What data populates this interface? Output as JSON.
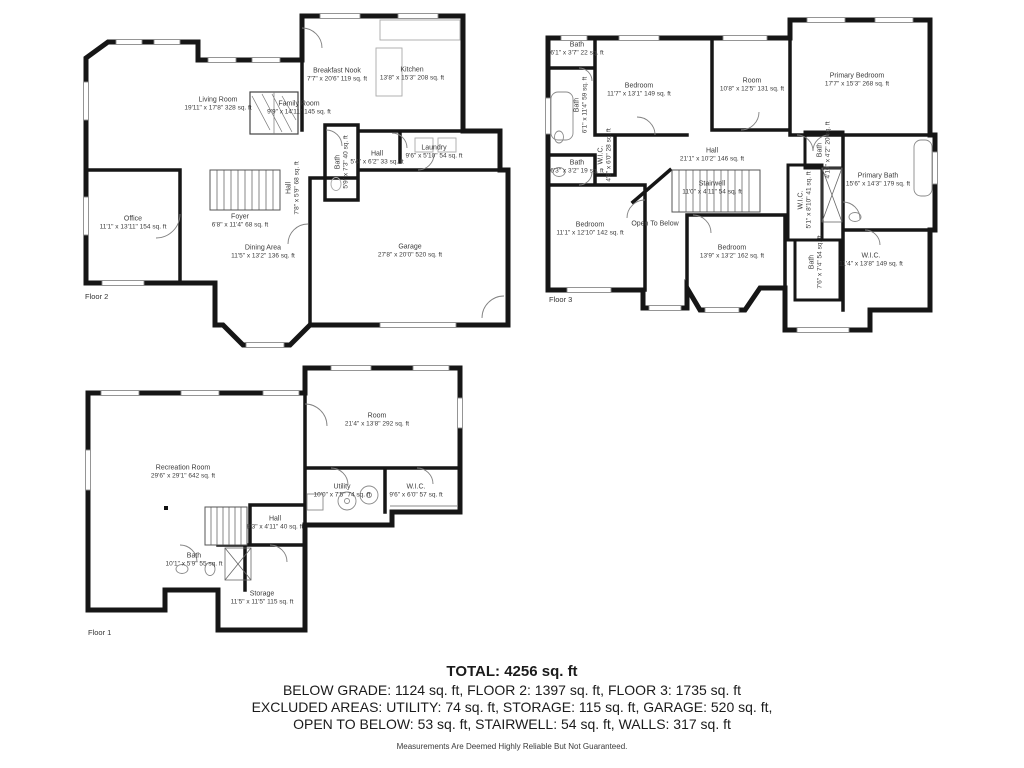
{
  "colors": {
    "wall": "#161616",
    "text": "#3c3c3c",
    "fixture": "#8a8a8a"
  },
  "summary": {
    "total": "TOTAL: 4256 sq. ft",
    "line2": "BELOW GRADE: 1124 sq. ft, FLOOR 2: 1397 sq. ft, FLOOR 3: 1735 sq. ft",
    "line3": "EXCLUDED AREAS: UTILITY: 74 sq. ft, STORAGE: 115 sq. ft, GARAGE: 520 sq. ft,",
    "line4": "OPEN TO BELOW: 53 sq. ft, STAIRWELL: 54 sq. ft, WALLS: 317 sq. ft",
    "disclaimer": "Measurements Are Deemed Highly Reliable But Not Guaranteed."
  },
  "floors": {
    "f2": {
      "label": "Floor 2",
      "rooms": {
        "living": {
          "name": "Living Room",
          "dims": "19'11\" x 17'8\" 328 sq. ft"
        },
        "family": {
          "name": "Family Room",
          "dims": "9'9\" x 14'11\" 145 sq. ft"
        },
        "breakfast": {
          "name": "Breakfast Nook",
          "dims": "7'7\" x 20'6\" 119 sq. ft"
        },
        "kitchen": {
          "name": "Kitchen",
          "dims": "13'8\" x 15'3\" 208 sq. ft"
        },
        "bath": {
          "name": "Bath",
          "dims": "5'9\" x 7'3\" 40 sq. ft"
        },
        "hall_small": {
          "name": "Hall",
          "dims": "5'4\" x 6'2\" 33 sq. ft"
        },
        "laundry": {
          "name": "Laundry",
          "dims": "9'6\" x 5'10\" 54 sq. ft"
        },
        "hall_stairs": {
          "name": "Hall",
          "dims": "7'8\" x 5'9\" 68 sq. ft"
        },
        "office": {
          "name": "Office",
          "dims": "11'1\" x 13'11\" 154 sq. ft"
        },
        "foyer": {
          "name": "Foyer",
          "dims": "6'8\" x 11'4\" 68 sq. ft"
        },
        "dining": {
          "name": "Dining Area",
          "dims": "11'5\" x 13'2\" 136 sq. ft"
        },
        "garage": {
          "name": "Garage",
          "dims": "27'8\" x 20'0\" 520 sq. ft"
        }
      }
    },
    "f3": {
      "label": "Floor 3",
      "rooms": {
        "bath22": {
          "name": "Bath",
          "dims": "6'1\" x 3'7\" 22 sq. ft"
        },
        "bath59": {
          "name": "Bath",
          "dims": "6'1\" x 11'4\" 59 sq. ft"
        },
        "bedroom1": {
          "name": "Bedroom",
          "dims": "11'7\" x 13'1\" 149 sq. ft"
        },
        "room": {
          "name": "Room",
          "dims": "10'8\" x 12'5\" 131 sq. ft"
        },
        "primary_bedroom": {
          "name": "Primary Bedroom",
          "dims": "17'7\" x 15'3\" 268 sq. ft"
        },
        "wic28": {
          "name": "W.I.C.",
          "dims": "4'8\" x 6'0\" 28 sq. ft"
        },
        "bath19": {
          "name": "Bath",
          "dims": "6'3\" x 3'2\" 19 sq. ft"
        },
        "hall": {
          "name": "Hall",
          "dims": "21'1\" x 10'2\" 146 sq. ft"
        },
        "stairwell": {
          "name": "Stairwell",
          "dims": "11'0\" x 4'11\" 54 sq. ft"
        },
        "bedroom_left": {
          "name": "Bedroom",
          "dims": "11'1\" x 12'10\" 142 sq. ft"
        },
        "open_below": {
          "name": "Open To Below",
          "dims": ""
        },
        "bedroom_center": {
          "name": "Bedroom",
          "dims": "13'9\" x 13'2\" 162 sq. ft"
        },
        "bath20": {
          "name": "Bath",
          "dims": "4'10\" x 4'2\" 20 sq. ft"
        },
        "wic41": {
          "name": "W.I.C.",
          "dims": "5'1\" x 8'10\" 41 sq. ft"
        },
        "primary_bath": {
          "name": "Primary Bath",
          "dims": "15'6\" x 14'3\" 179 sq. ft"
        },
        "bath54": {
          "name": "Bath",
          "dims": "7'6\" x 7'4\" 54 sq. ft"
        },
        "wic149": {
          "name": "W.I.C.",
          "dims": "11'4\" x 13'8\" 149 sq. ft"
        }
      }
    },
    "f1": {
      "label": "Floor 1",
      "rooms": {
        "recreation": {
          "name": "Recreation Room",
          "dims": "29'6\" x 29'1\" 642 sq. ft"
        },
        "room": {
          "name": "Room",
          "dims": "21'4\" x 13'8\" 292 sq. ft"
        },
        "utility": {
          "name": "Utility",
          "dims": "10'0\" x 7'5\" 74 sq. ft"
        },
        "wic": {
          "name": "W.I.C.",
          "dims": "9'6\" x 6'0\" 57 sq. ft"
        },
        "hall": {
          "name": "Hall",
          "dims": "8'3\" x 4'11\" 40 sq. ft"
        },
        "bath": {
          "name": "Bath",
          "dims": "10'1\" x 5'9\" 55 sq. ft"
        },
        "storage": {
          "name": "Storage",
          "dims": "11'5\" x 11'5\" 115 sq. ft"
        }
      }
    }
  }
}
